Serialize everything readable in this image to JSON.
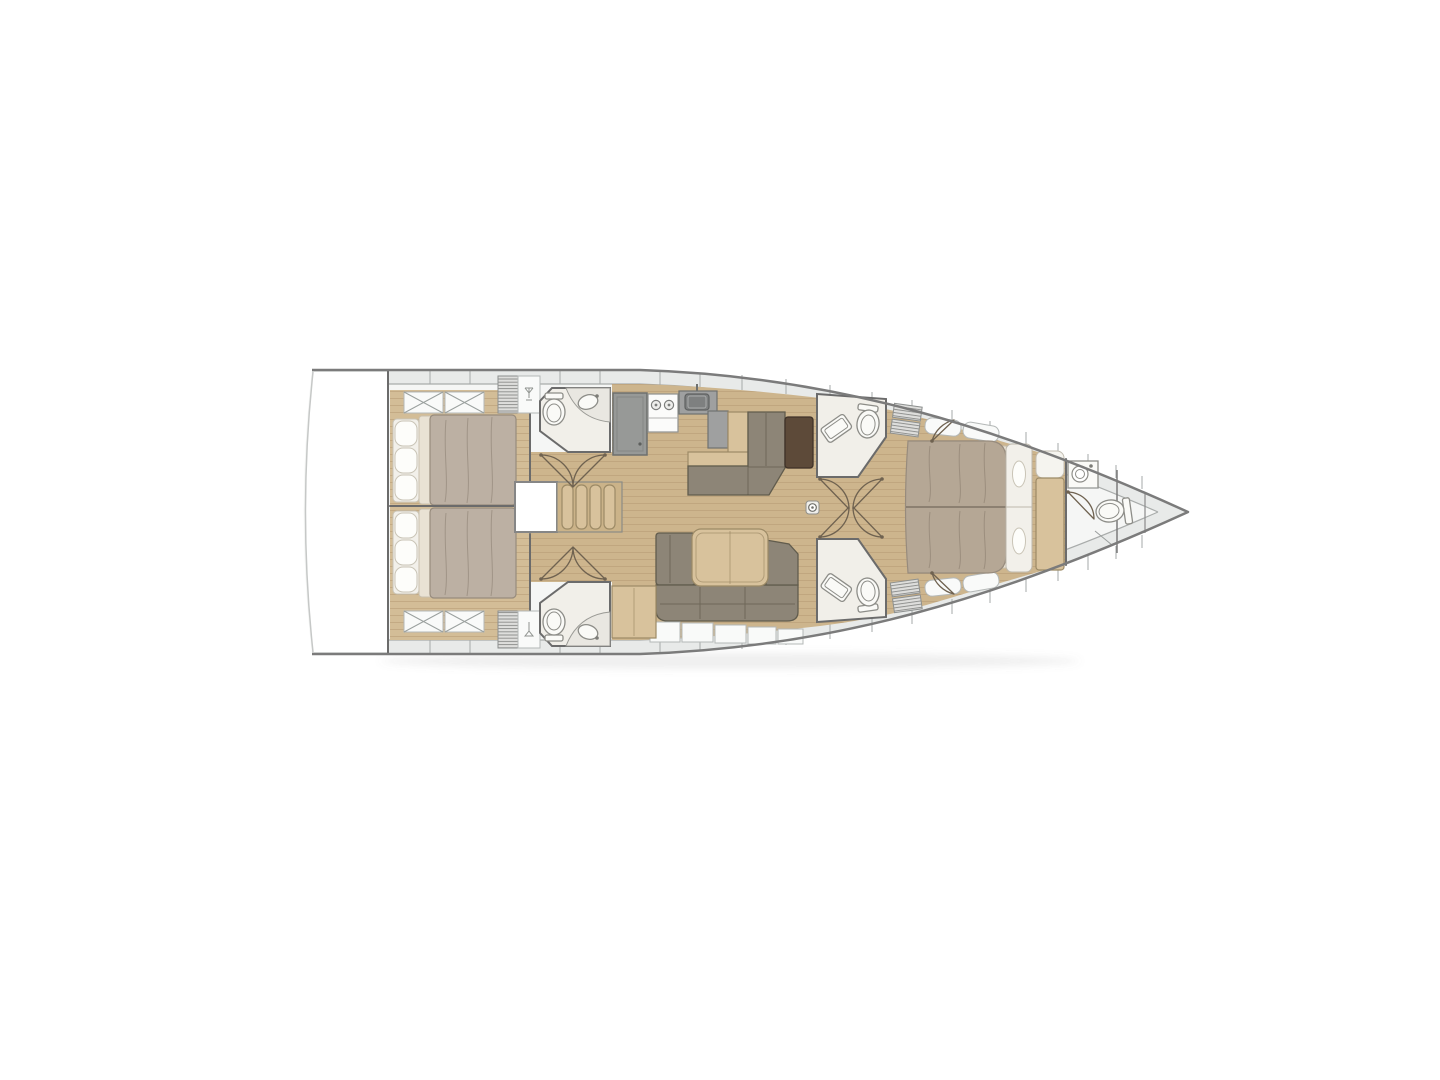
{
  "diagram": {
    "type": "boat-floor-plan",
    "description": "Top-view interior layout plan of a monohull sailing yacht, bow pointing right",
    "orientation": {
      "bow": "right",
      "stern": "left"
    },
    "rooms": [
      {
        "id": "swim-platform"
      },
      {
        "id": "aft-cabin-top"
      },
      {
        "id": "aft-cabin-bottom"
      },
      {
        "id": "aft-head-top"
      },
      {
        "id": "aft-head-bottom"
      },
      {
        "id": "companionway-stairs"
      },
      {
        "id": "engine-box"
      },
      {
        "id": "galley"
      },
      {
        "id": "nav-station"
      },
      {
        "id": "salon"
      },
      {
        "id": "mid-head-top"
      },
      {
        "id": "mid-head-bottom"
      },
      {
        "id": "forward-cabin"
      },
      {
        "id": "bow-bathroom"
      }
    ],
    "fixture_counts": {
      "toilets": 5,
      "washbasins": 5,
      "galley_sink": 1,
      "stove_burners": 2,
      "double_beds": 3,
      "sofas": 2,
      "tables": 2,
      "stair_treads": 4,
      "mast_step": 1
    }
  },
  "colors": {
    "background": "#ffffff",
    "hull_line": "#7b7b7b",
    "deck_band": "#e8eae9",
    "deck_inner_line": "#a9acab",
    "panel_white": "#f9faf9",
    "panel_border": "#b4b8b7",
    "hull_fill": "#f5f6f5",
    "floor_wood": "#cdb58d",
    "floor_wood_light": "#d3bd97",
    "plank_line": "#b39871",
    "furniture_wood": "#d8c29c",
    "furniture_wood_border": "#9c8a66",
    "mattress": "#bcb0a3",
    "mattress_fwd": "#b5a795",
    "mattress_border": "#978b7d",
    "bedding_cream": "#e9e2d4",
    "bedding_white": "#f2f0ea",
    "sofa": "#8d8577",
    "sofa_border": "#615c4d",
    "counter_gray": "#9fa0a0",
    "counter_border": "#6f7170",
    "chart_table": "#5d4a39",
    "chart_table_border": "#3f3228",
    "room_white": "#f1efe9",
    "wall": "#6b6b6b",
    "fixture_white": "#fafaf7",
    "fixture_border": "#8d8d88",
    "hatch_bg": "#dededc",
    "hatch_line": "#90918f",
    "door_arc": "#6f6250",
    "shadow": "rgba(120,120,120,0.12)"
  }
}
